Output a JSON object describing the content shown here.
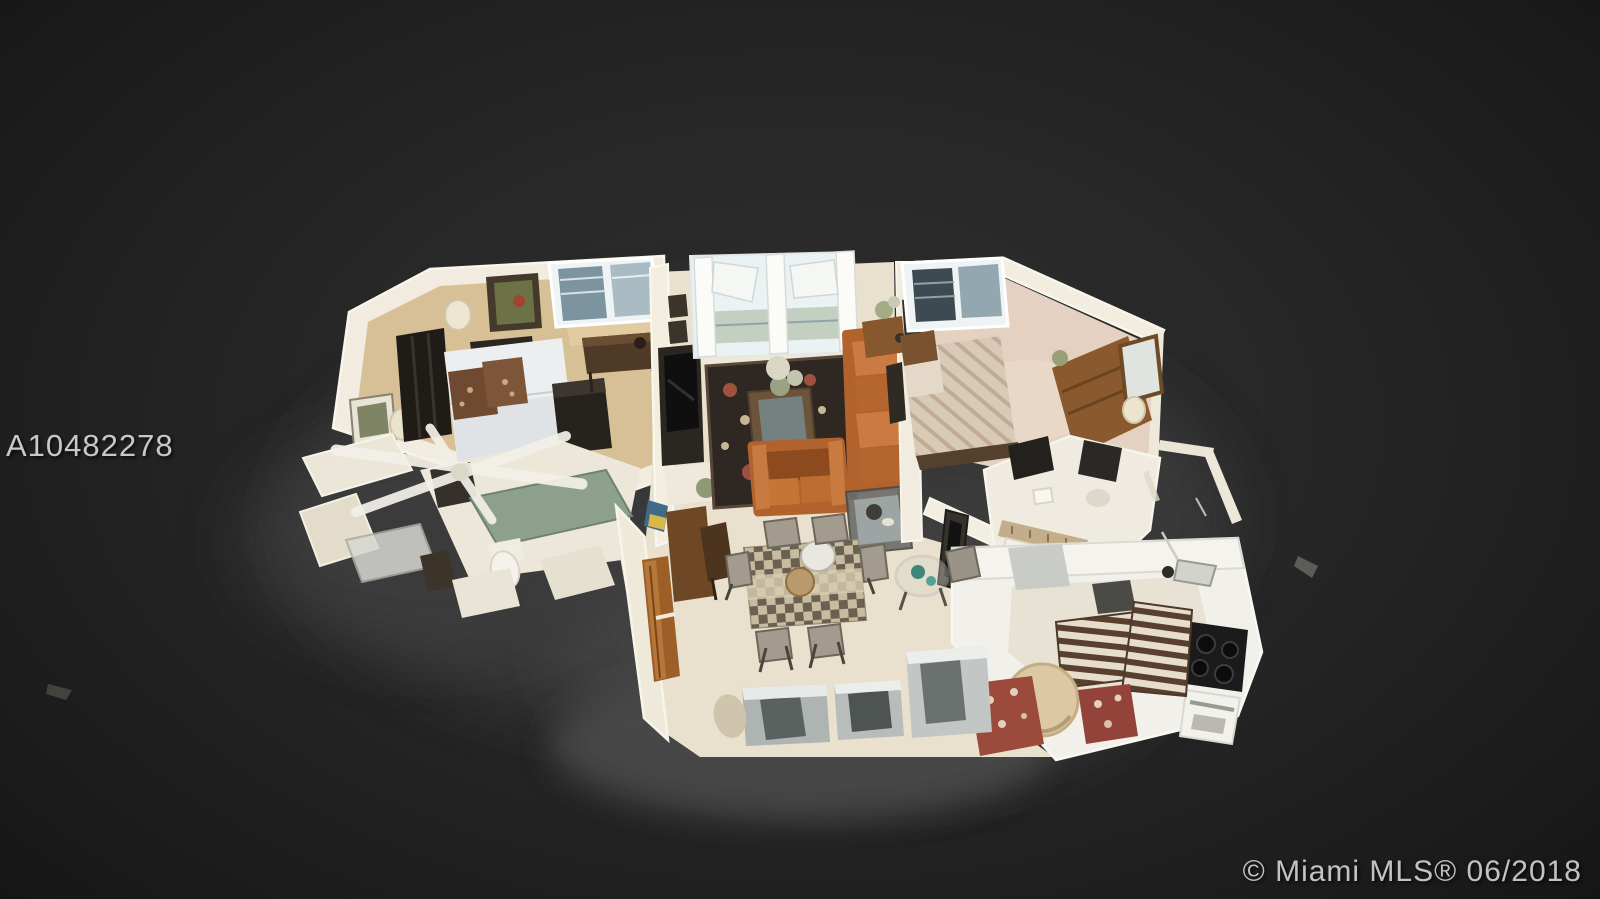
{
  "watermark": {
    "listing_id": "A10482278"
  },
  "footer": {
    "credit": "© Miami MLS® 06/2018"
  },
  "scene": {
    "description": "3D dollhouse top-down scan of a furnished condo: master bedroom and bathroom at left, living room with balcony doors at center, second bedroom and bathroom at right, dining area below center, kitchen with breakfast table at lower right",
    "palette": {
      "background_center": "#2f2f2f",
      "background_edge": "#161616",
      "wall_cream": "#f1ecdf",
      "carpet_master": "#d7bf96",
      "carpet_bedroom2": "#e4d1c1",
      "tile_floor": "#e9e1cd",
      "sofa_orange": "#b2622d",
      "area_rug_dark": "#2e2722",
      "wood_medium": "#8a5a2e",
      "door_wood": "#9c5f28",
      "vanity_teal": "#8da08c",
      "cooktop_black": "#1b1b1b",
      "watermark_text": "#c8c8c8",
      "credit_text": "#c2c2c2"
    }
  }
}
